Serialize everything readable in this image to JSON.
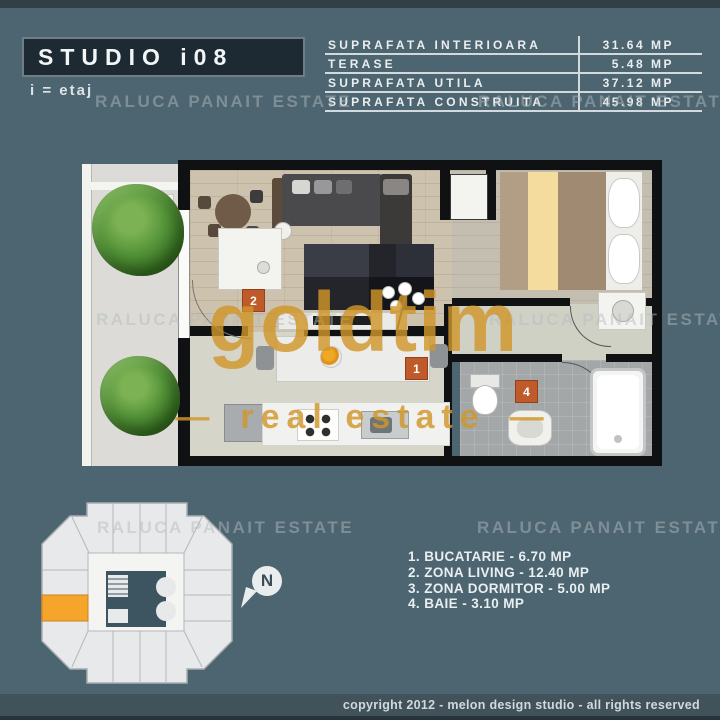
{
  "canvas": {
    "width": 720,
    "height": 720,
    "bg": "#4d6570"
  },
  "header": {
    "title": "STUDIO i08",
    "subtitle": "i = etaj",
    "table": {
      "rows": [
        {
          "label": "SUPRAFATA INTERIOARA",
          "value": "31.64 MP"
        },
        {
          "label": "TERASE",
          "value": "5.48 MP"
        },
        {
          "label": "SUPRAFATA UTILA",
          "value": "37.12 MP"
        },
        {
          "label": "SUPRAFATA CONSTRUITA",
          "value": "45.98 MP"
        }
      ]
    }
  },
  "watermarks": {
    "agency": "RALUCA PANAIT ESTATE",
    "brand": "goldtim",
    "brand_sub": "real estate",
    "dash": "—",
    "brand_color": "#d0962a"
  },
  "floorplan": {
    "marker_color": "#bf5a2a",
    "markers": {
      "kitchen": "1",
      "living": "2",
      "bathroom": "4"
    }
  },
  "legend": {
    "items": [
      "1. BUCATARIE - 6.70 MP",
      "2. ZONA LIVING - 12.40 MP",
      "3. ZONA DORMITOR - 5.00 MP",
      "4. BAIE - 3.10 MP"
    ]
  },
  "compass": {
    "label": "N"
  },
  "keyplan": {
    "highlight_color": "#f5a42c"
  },
  "footer": {
    "copyright": "copyright 2012 - melon design studio - all rights reserved"
  }
}
